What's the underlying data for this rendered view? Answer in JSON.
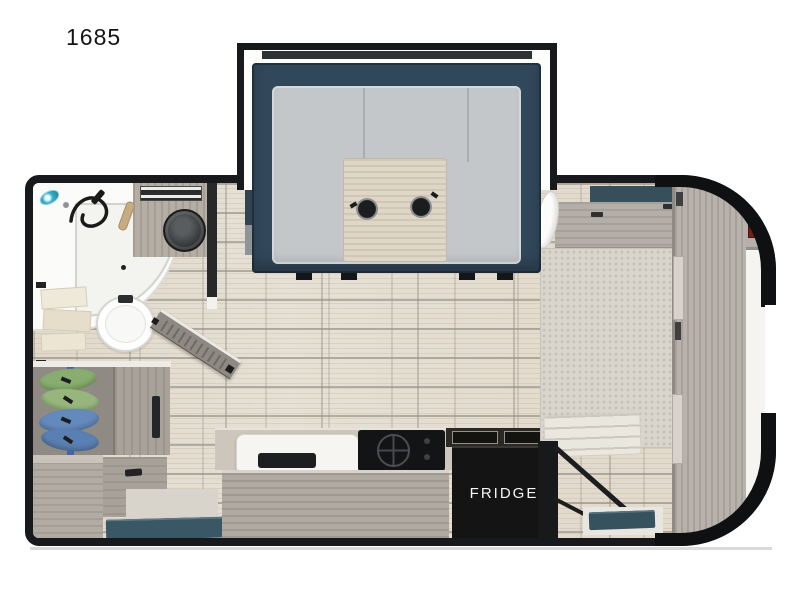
{
  "model_label": "1685",
  "labels": {
    "fridge": "FRIDGE"
  },
  "colors": {
    "wall_black": "#17191c",
    "dinette_slate": "#31475a",
    "cushion_gray": "#c3c7ca",
    "table_wood": "#ded7c8",
    "floor_plank": "#e6e0d5",
    "floor_grout": "#968f85",
    "counter_wood": "#b0aaa2",
    "fridge_black": "#141414",
    "teal_mat": "#3a5765",
    "clothes_green": "#88ad6e",
    "clothes_blue": "#6489bc",
    "vent_red": "#7b1d12",
    "showerhead_teal": "#35b0c8",
    "mattress": "#d9d5cc",
    "cabinet_wood": "#b7b2ab"
  },
  "fixtures": [
    "dinette-slide-out",
    "u-dinette-cushions",
    "dinette-table",
    "cup-holders",
    "corner-shower",
    "handheld-shower-wand",
    "vanity-sink",
    "toilet",
    "towel-shelf",
    "louvered-bathroom-door",
    "hanging-clothes-closet",
    "dresser",
    "entry-step-mat",
    "kitchen-sink",
    "cooktop",
    "griddle-grate",
    "refrigerator",
    "bed-mattress",
    "bed-lift-strut",
    "headboard-cabinet",
    "front-wardrobe",
    "front-vent-window",
    "plank-tile-floor"
  ]
}
